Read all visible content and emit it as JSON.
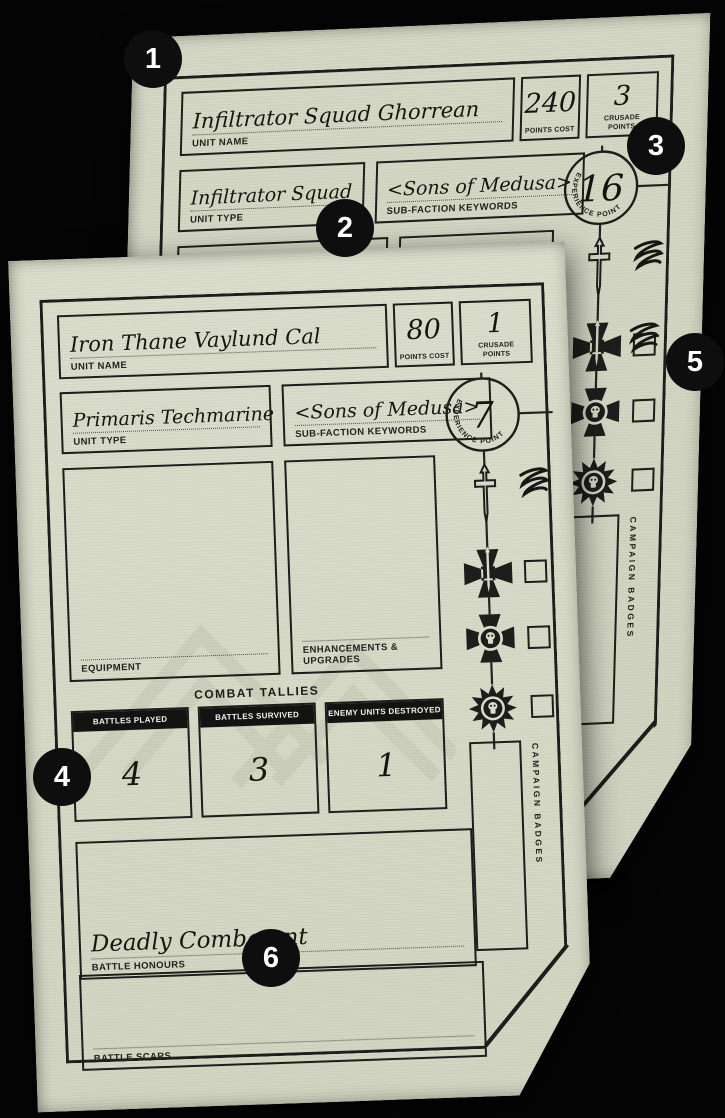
{
  "background_color": "#050505",
  "colors": {
    "paper": "#dadcca",
    "paper_back": "#d3d5c4",
    "ink": "#1d1d1b",
    "tally_header_bg": "#131311",
    "badge_bg": "#0e0e0e",
    "badge_text": "#ffffff",
    "watermark": "#7d8a6a"
  },
  "labels": {
    "unit_name": "UNIT NAME",
    "points_cost": "POINTS COST",
    "crusade_points": "CRUSADE POINTS",
    "unit_type": "UNIT TYPE",
    "subfaction": "SUB-FACTION KEYWORDS",
    "equipment": "EQUIPMENT",
    "enhancements": "ENHANCEMENTS & UPGRADES",
    "combat_tallies": "COMBAT TALLIES",
    "battle_honours": "BATTLE HONOURS",
    "battle_scars": "BATTLE SCARS",
    "experience_points": "EXPERIENCE POINTS",
    "campaign_badges": "CAMPAIGN BADGES"
  },
  "cards": {
    "back": {
      "unit_name": "Infiltrator Squad Ghorrean",
      "points_cost": "240",
      "crusade_points": "3",
      "unit_type": "Infiltrator Squad",
      "subfaction": "<Sons of Medusa>",
      "equipment_entry": "Comms Array",
      "experience_points": "16"
    },
    "front": {
      "unit_name": "Iron Thane Vaylund Cal",
      "points_cost": "80",
      "crusade_points": "1",
      "unit_type": "Primaris Techmarine",
      "subfaction": "<Sons of Medusa>",
      "experience_points": "7",
      "battle_honours_entry": "Deadly Combatant",
      "tallies": [
        {
          "label": "BATTLES PLAYED",
          "value": "4"
        },
        {
          "label": "BATTLES SURVIVED",
          "value": "3"
        },
        {
          "label": "ENEMY UNITS DESTROYED",
          "value": "1"
        }
      ]
    }
  },
  "annotations": [
    {
      "number": "1"
    },
    {
      "number": "2"
    },
    {
      "number": "3"
    },
    {
      "number": "4"
    },
    {
      "number": "5"
    },
    {
      "number": "6"
    }
  ],
  "icons": {
    "rank_track": [
      "dagger-icon",
      "cross-sword-icon",
      "cross-skull-icon",
      "starburst-skull-icon"
    ],
    "marks": [
      "pen-scribble",
      "rank-checkbox"
    ]
  }
}
